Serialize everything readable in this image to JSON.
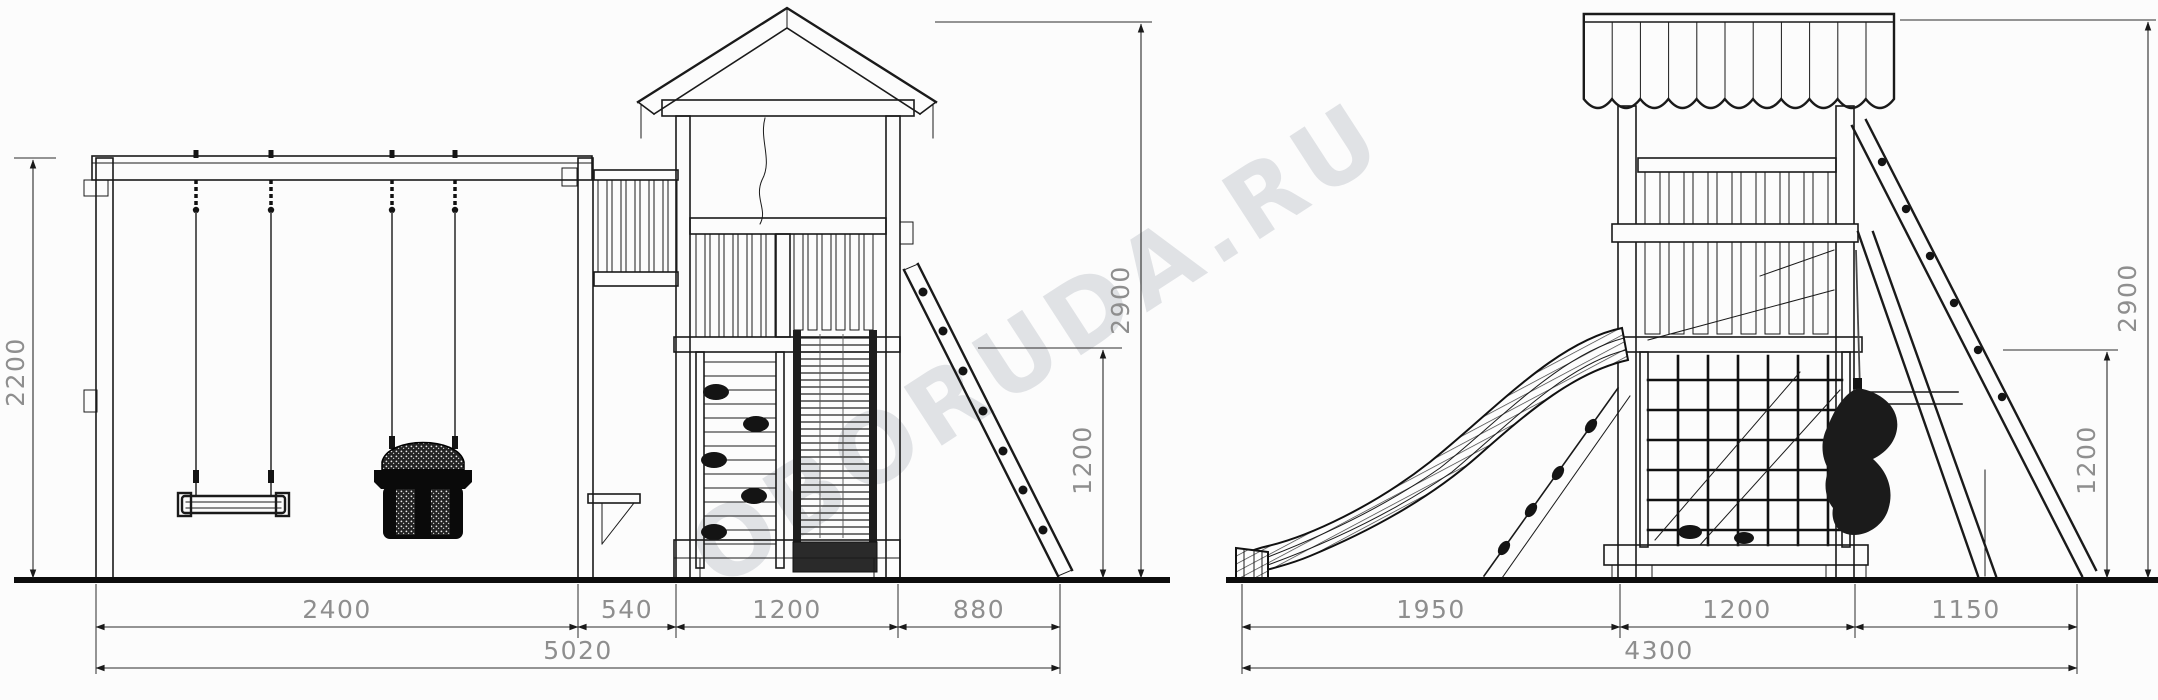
{
  "front_view": {
    "dim_swing_height": "2200",
    "dim_total_height": "2900",
    "dim_platform_height": "1200",
    "dim_segments": [
      "2400",
      "540",
      "1200",
      "880"
    ],
    "dim_total_width": "5020"
  },
  "side_view": {
    "dim_total_height": "2900",
    "dim_platform_height": "1200",
    "dim_segments": [
      "1950",
      "1200",
      "1150"
    ],
    "dim_total_width": "4300"
  },
  "watermark": {
    "text": "OBORUDA.RU"
  },
  "colors": {
    "line": "#1a1a1a",
    "dim_text": "#8e8e8e",
    "background": "#fcfcfc"
  }
}
